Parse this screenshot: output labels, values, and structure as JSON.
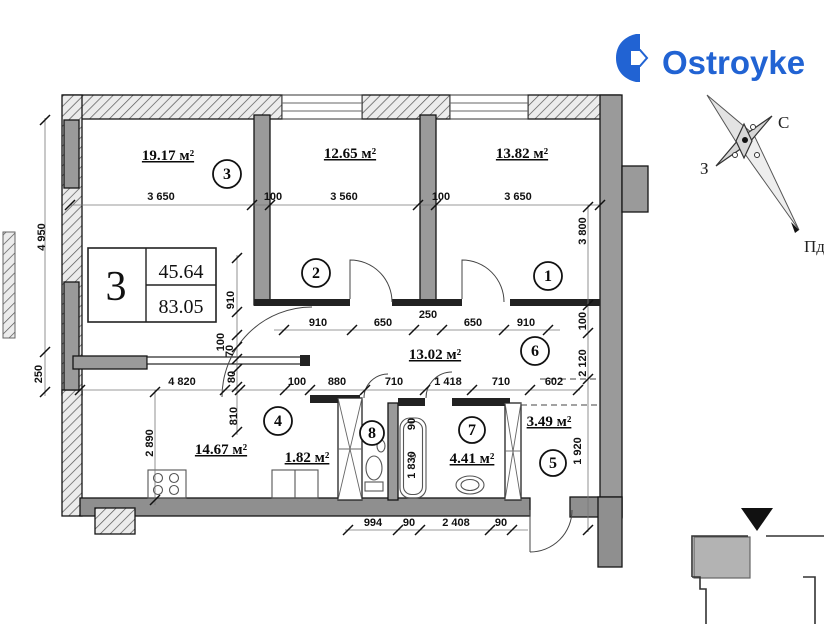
{
  "logo": {
    "text": "Ostroyke",
    "color": "#2163d3"
  },
  "compass": {
    "north": "С",
    "west": "З",
    "south": "Пд"
  },
  "unit_table": {
    "room_count": "3",
    "living_area": "45.64",
    "total_area": "83.05"
  },
  "rooms": [
    {
      "number": "3",
      "area": "19.17 м²"
    },
    {
      "number": "2",
      "area": "12.65 м²"
    },
    {
      "number": "1",
      "area": "13.82 м²"
    },
    {
      "number": "6",
      "area": "13.02 м²"
    },
    {
      "number": "4",
      "area": "14.67 м²"
    },
    {
      "number": "8",
      "area": "1.82 м²"
    },
    {
      "number": "7",
      "area": "4.41 м²"
    },
    {
      "number": "5",
      "area": "3.49 м²"
    }
  ],
  "dims": {
    "top": [
      "3 650",
      "100",
      "3 560",
      "100",
      "3 650"
    ],
    "mid": [
      "910",
      "650",
      "250",
      "650",
      "910"
    ],
    "lower": [
      "4 820",
      "100",
      "880",
      "710",
      "1 418",
      "710",
      "602"
    ],
    "bottom": [
      "994",
      "90",
      "2 408",
      "90"
    ],
    "left": [
      "4 950",
      "250"
    ],
    "left_inner": [
      "2 890"
    ],
    "right": [
      "3 800",
      "100",
      "2 120",
      "1 920"
    ],
    "center": [
      "910",
      "100",
      "70",
      "80",
      "810"
    ],
    "bath": [
      "90",
      "1 830"
    ]
  },
  "colors": {
    "wall": "#9a9a9a",
    "logo_blue": "#2163d3"
  }
}
